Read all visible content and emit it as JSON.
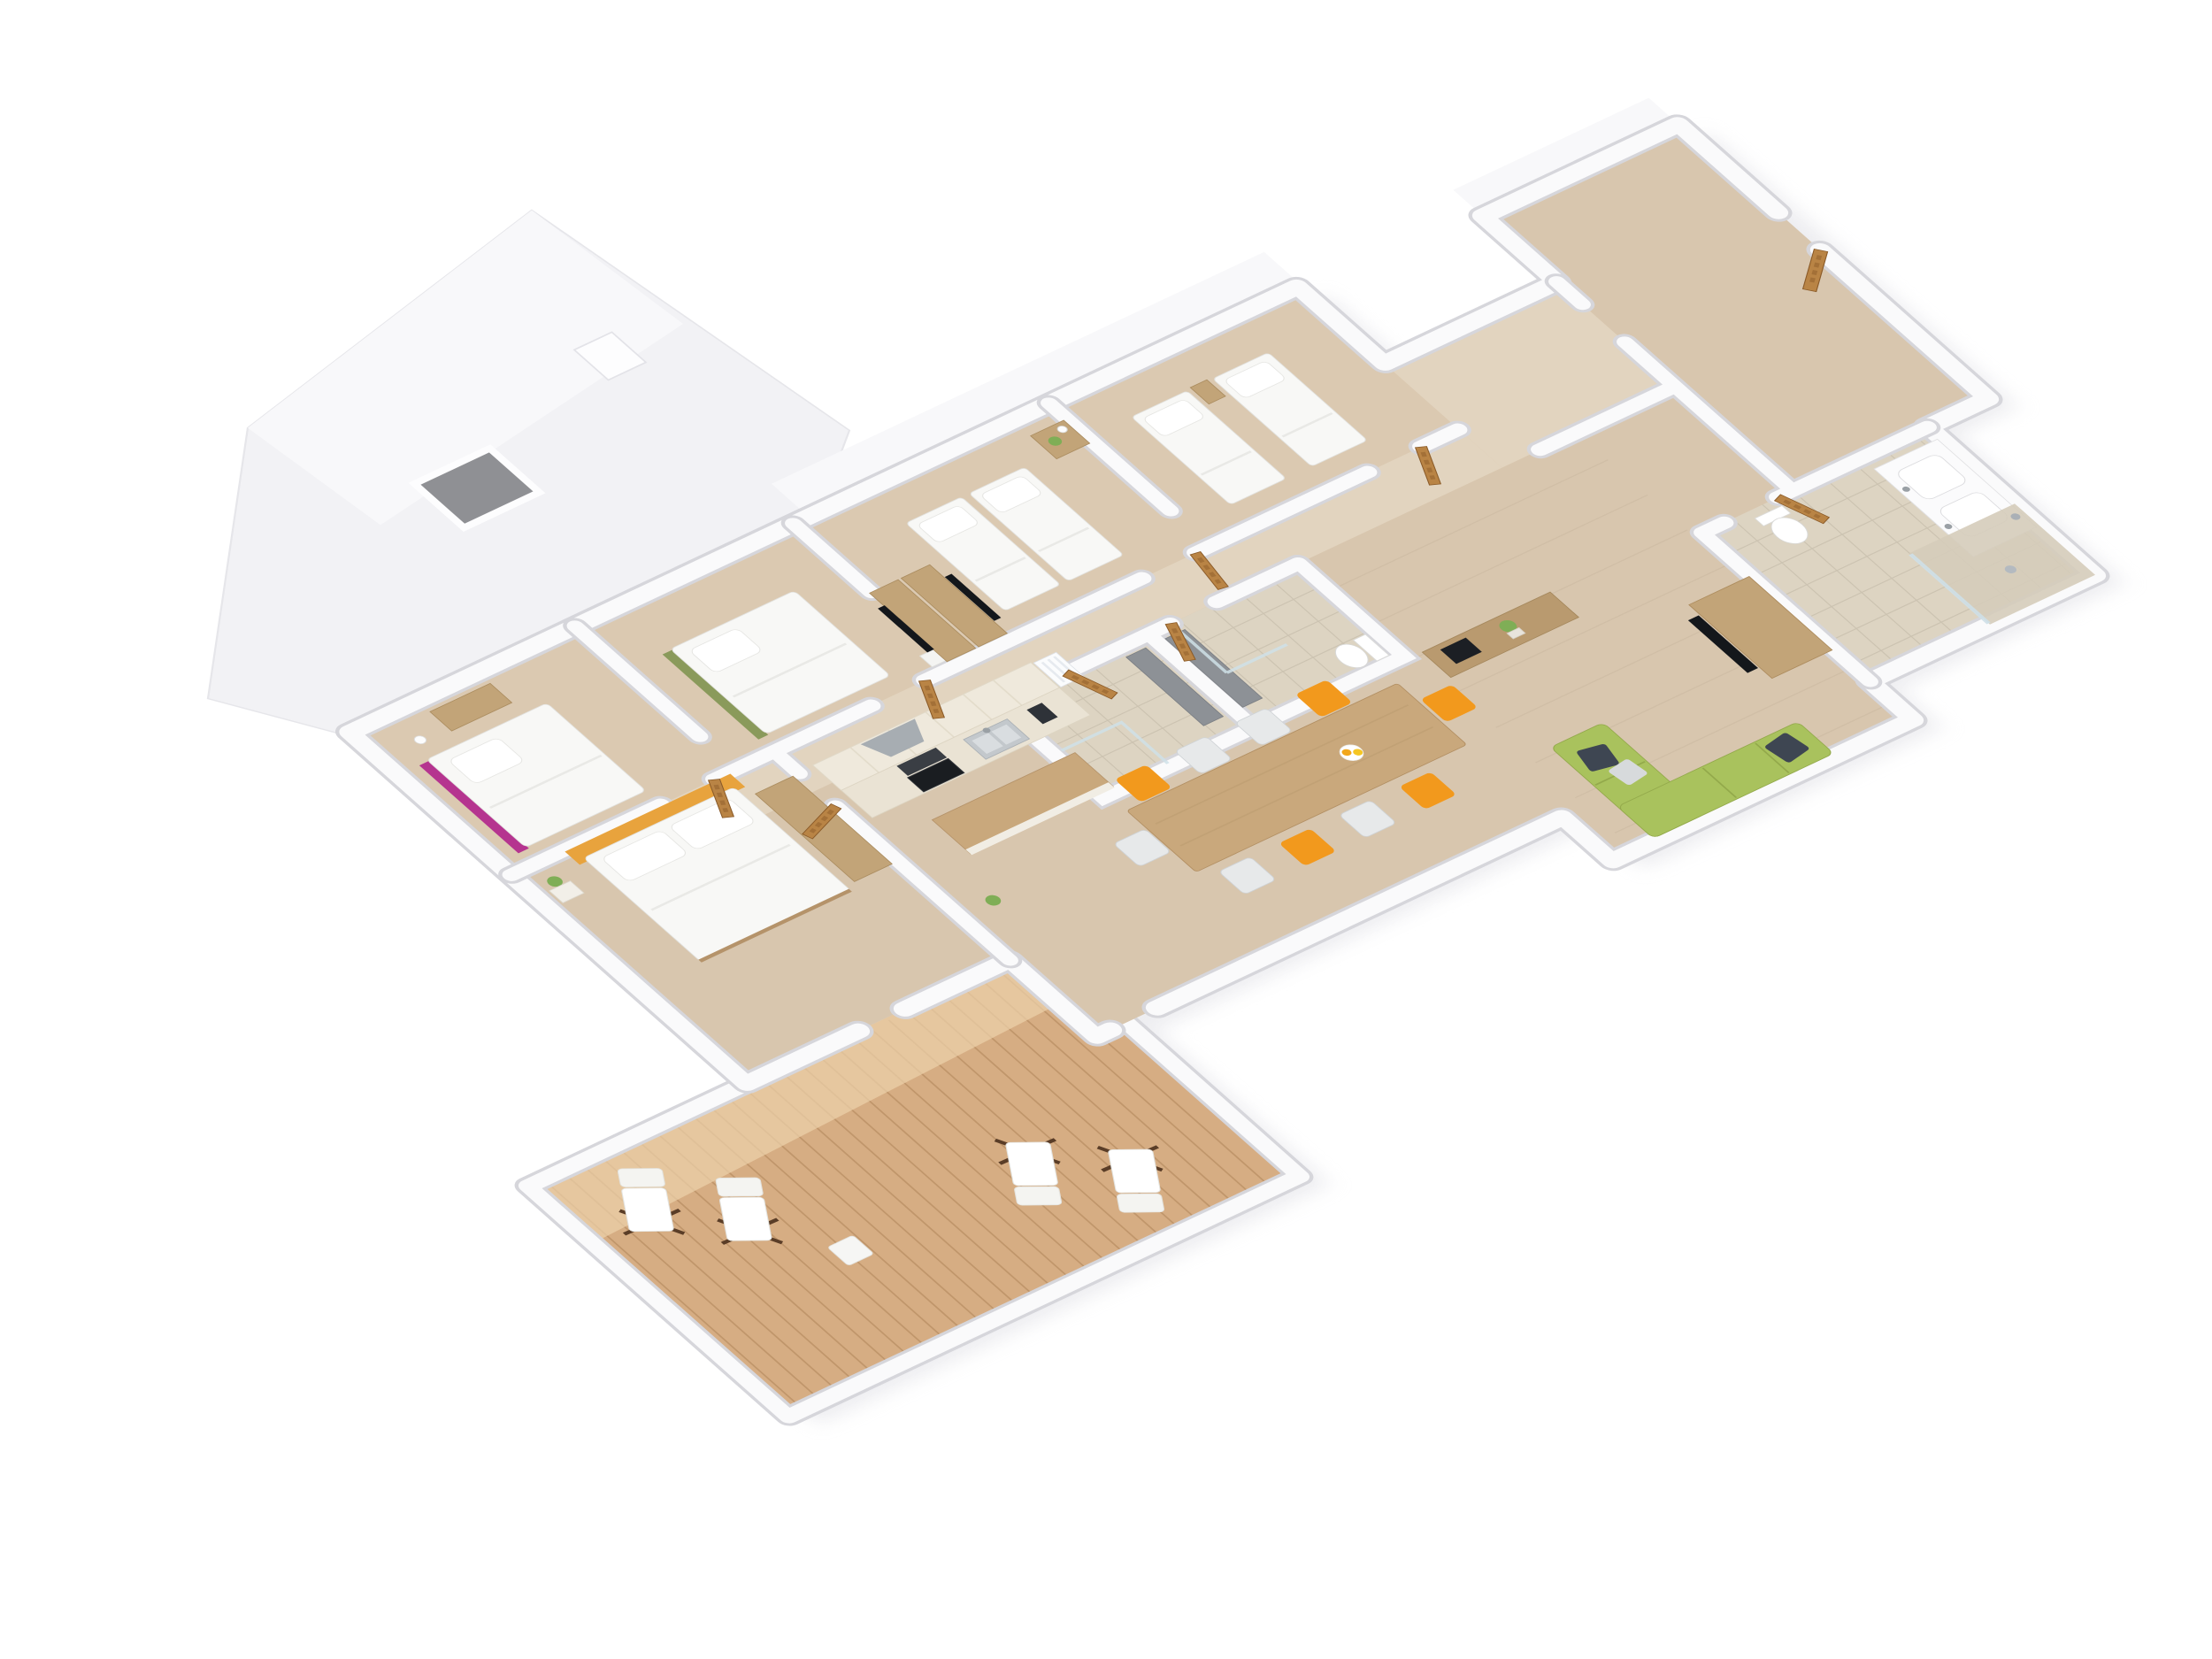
{
  "meta": {
    "kind": "isometric 3d cutaway apartment floor plan render",
    "background": "#ffffff"
  },
  "colors": {
    "shadow": "#dcdce2",
    "wallWhite": "#fafafb",
    "wallShadow": "#d6d6db",
    "roofWhite": "#f2f2f5",
    "roofLight": "#f8f8fa",
    "skylightGray": "#8f9094",
    "floorWood": "#d8c6ae",
    "floorBand": "#dbc9b1",
    "floorCorridor": "#e2d4bf",
    "floorTile": "#ddd4c2",
    "tileLine": "#cbc2b0",
    "floorLine": "#ccbaa2",
    "deckWood": "#d6ad83",
    "deckLight": "#ecd2ab",
    "deckLine": "#bb9166",
    "doorWood": "#b98445",
    "doorWoodDark": "#8a5a28",
    "furnWood": "#c2a478",
    "woodDark": "#b5936a",
    "islandWood": "#c9a87c",
    "sideboardWood": "#b99a6f",
    "cabinetCream": "#efe9dc",
    "counterCream": "#eae3d4",
    "bedWhite": "#f8f8f6",
    "pillowWhite": "#ffffff",
    "orangeAccent": "#e8a33d",
    "chairOrange": "#f2991d",
    "chairPale": "#e7e9ea",
    "greenSofa": "#a9c25d",
    "greenTrim": "#8a9a5b",
    "magentaAccent": "#b5348f",
    "darkPillow": "#3e4652",
    "lightPillow": "#d7dadc",
    "tvBlack": "#14171b",
    "ovenBlack": "#1a1d21",
    "cooktopGray": "#3a3e44",
    "steel": "#c3c8cc",
    "hoodGray": "#a7adb2",
    "slabGray": "#8d9196",
    "glass": "#cfe0e8",
    "plantGreen": "#7fae56",
    "frameBrown": "#5a3d27"
  },
  "scene": {
    "projection": "oblique isometric, white background, low white walls, light oak floors",
    "rooms": [
      {
        "name": "attic-bedroom",
        "furniture": [
          "double bed with magenta frame",
          "wardrobe",
          "shelf lamp"
        ]
      },
      {
        "name": "bedroom-green",
        "furniture": [
          "bed with green trim",
          "wardrobe columns",
          "tv screen",
          "nightstand"
        ]
      },
      {
        "name": "twin-bedroom",
        "furniture": [
          "2 single beds",
          "nightstand with plant and lamp"
        ]
      },
      {
        "name": "bedroom-four",
        "furniture": [
          "2 single beds",
          "nightstand"
        ]
      },
      {
        "name": "shower-room-a",
        "furniture": [
          "walk-in shower",
          "gray panel",
          "towel"
        ]
      },
      {
        "name": "shower-room-b",
        "furniture": [
          "walk-in shower",
          "gray panel",
          "toilet"
        ]
      },
      {
        "name": "master-bedroom",
        "furniture": [
          "double bed with orange headboard",
          "wardrobe",
          "plant"
        ]
      },
      {
        "name": "kitchen",
        "furniture": [
          "tall cabinets",
          "counter with sink",
          "oven",
          "cooktop",
          "extractor hood",
          "radiator",
          "island bar",
          "plant"
        ]
      },
      {
        "name": "dining-area",
        "furniture": [
          "long wood table",
          "10 chairs (5 orange, 5 pale)",
          "fruit bowl"
        ]
      },
      {
        "name": "hallway",
        "furniture": [
          "sideboard with black box and plant"
        ]
      },
      {
        "name": "living-corner",
        "furniture": [
          "green corner sofa",
          "2 dark pillows",
          "light pillow",
          "tv on wood unit"
        ]
      },
      {
        "name": "bathroom",
        "furniture": [
          "double sink vanity",
          "toilet",
          "walk-in shower with glass"
        ]
      },
      {
        "name": "entrance-room",
        "furniture": []
      },
      {
        "name": "terrace",
        "furniture": [
          "4 folding deck chairs",
          "side table"
        ]
      }
    ],
    "counts": {
      "bedrooms": 5,
      "beds": 7,
      "dining_chairs": 10,
      "deck_chairs": 4,
      "wood_doors": 9,
      "skylight_windows": 1
    }
  }
}
